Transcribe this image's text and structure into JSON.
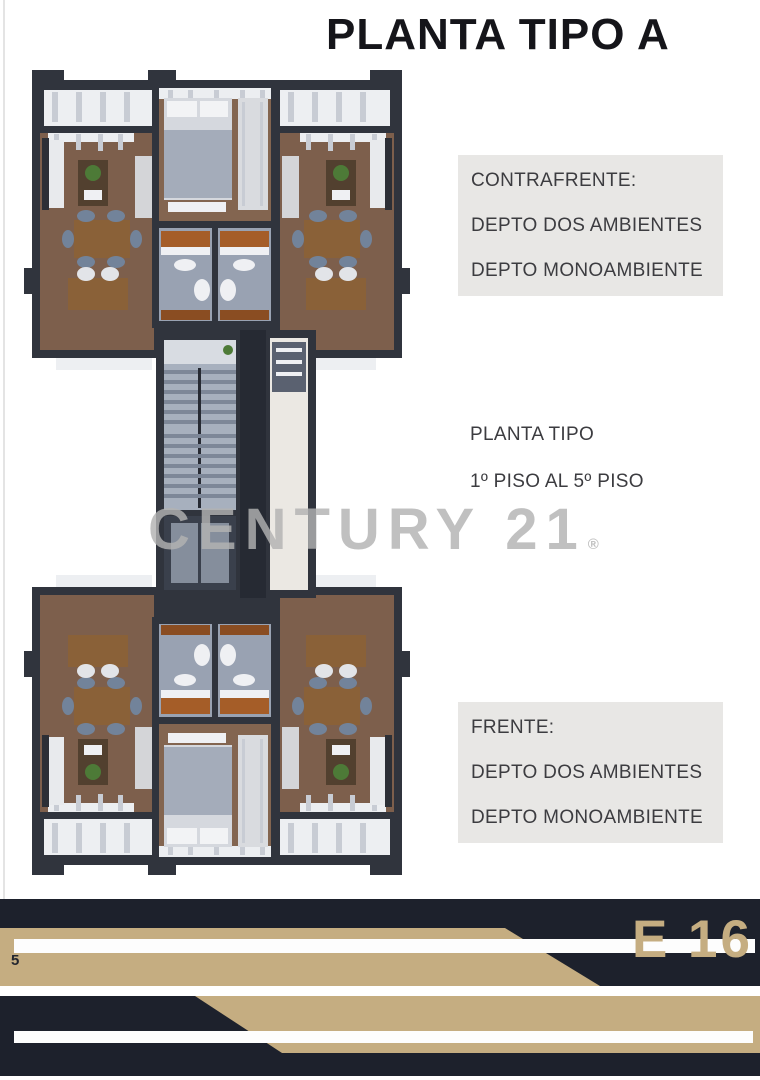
{
  "page": {
    "title": "PLANTA TIPO A",
    "page_number": "5",
    "building_code": "E 16"
  },
  "watermark": {
    "text": "CENTURY 21",
    "registered_mark": "®"
  },
  "notes": {
    "contrafrente": {
      "heading": "CONTRAFRENTE:",
      "line1": "DEPTO DOS AMBIENTES",
      "line2": "DEPTO MONOAMBIENTE"
    },
    "planta_tipo": {
      "line1": "PLANTA TIPO",
      "line2": "1º PISO AL 5º PISO"
    },
    "frente": {
      "heading": "FRENTE:",
      "line1": "DEPTO DOS AMBIENTES",
      "line2": "DEPTO MONOAMBIENTE"
    }
  },
  "colors": {
    "accent_tan": "#c5ad81",
    "footer_dark": "#1d212c",
    "note_box_gray": "#e8e7e5",
    "wall_dark": "#30343d",
    "wood_floor": "#7d5f4c",
    "watermark_gray": "#b2b2b2"
  }
}
